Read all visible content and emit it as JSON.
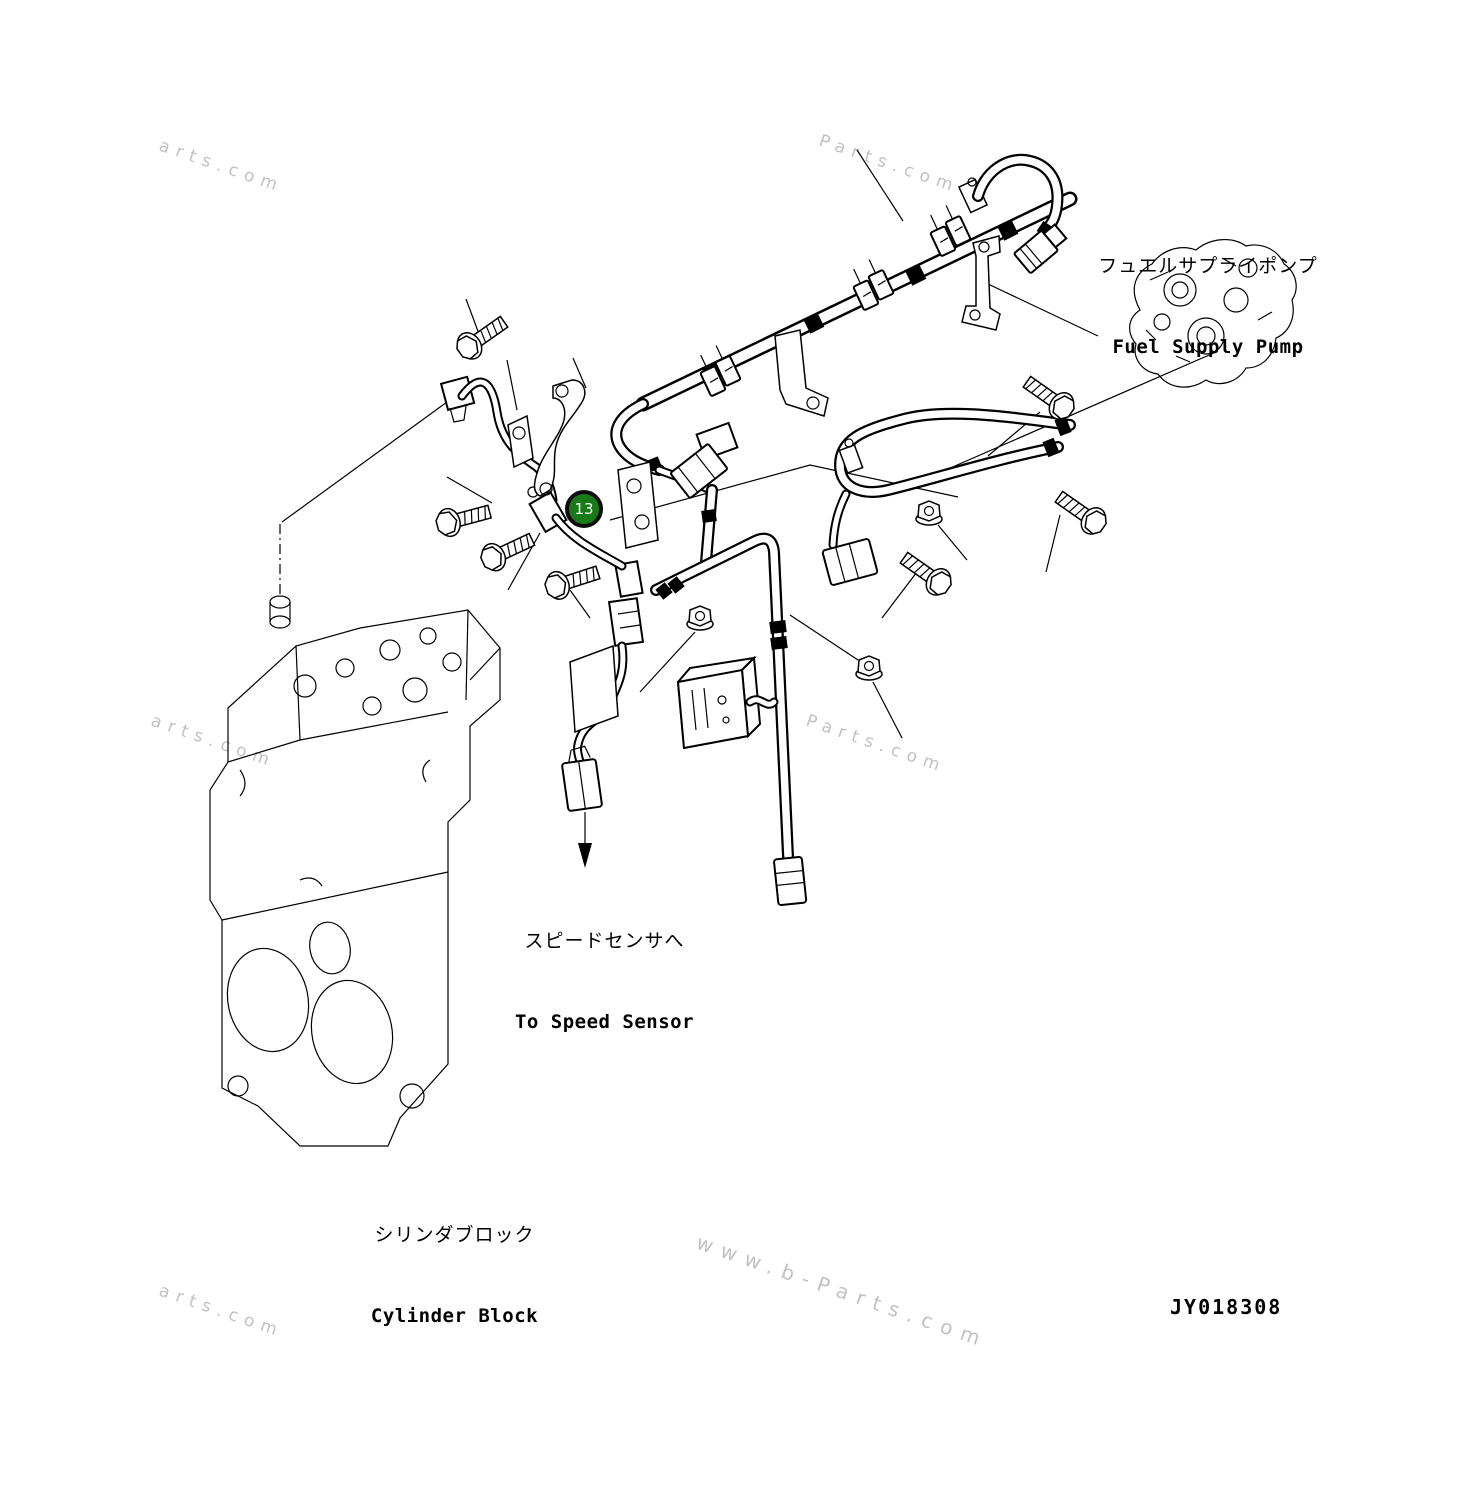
{
  "page": {
    "background": "#ffffff"
  },
  "drawing_number": "JY018308",
  "callout": {
    "number": "13"
  },
  "labels": {
    "fuel_pump": {
      "jp": "フュエルサプライポンプ",
      "en": "Fuel Supply Pump"
    },
    "speed_sensor": {
      "jp": "スピードセンサへ",
      "en": "To Speed Sensor"
    },
    "cylinder_block": {
      "jp": "シリンダブロック",
      "en": "Cylinder Block"
    }
  },
  "watermarks": [
    "arts.com",
    "Parts.com",
    "arts.com",
    "Parts.com",
    "www.b-Parts.com",
    "arts.com"
  ],
  "colors": {
    "line": "#000000",
    "watermark": "#8f8f8f",
    "callout_green": "#1a7a1a",
    "callout_ring": "#0c0c0c"
  }
}
